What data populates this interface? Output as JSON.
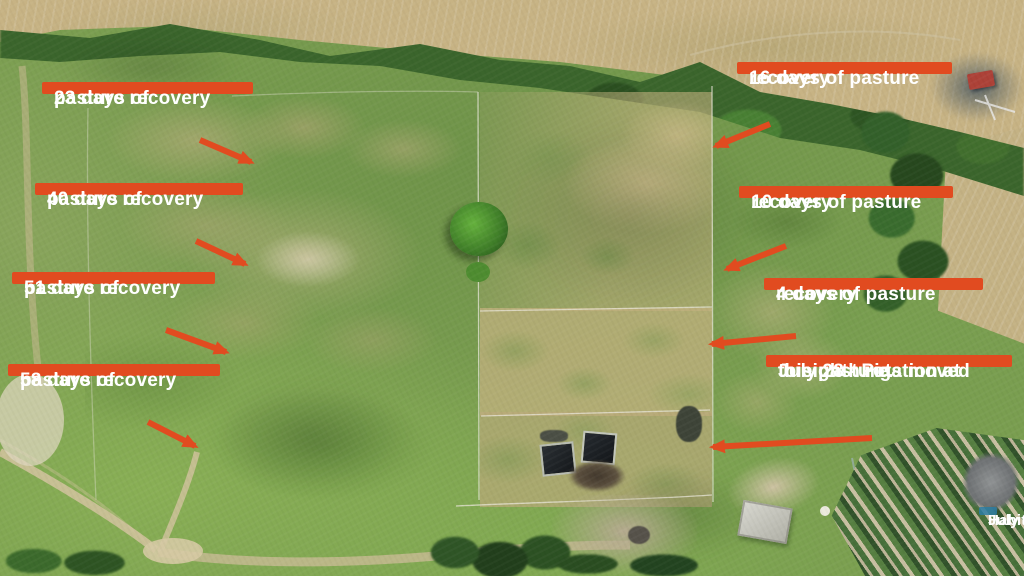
{
  "annotations": {
    "left": [
      {
        "line1": "23 days of",
        "line2": "pasture recovery"
      },
      {
        "line1": "40 days of",
        "line2": "pasture recovery"
      },
      {
        "line1": "51 days of",
        "line2": "pasture recovery"
      },
      {
        "line1": "58 days of",
        "line2": "pasture recovery"
      }
    ],
    "right": [
      {
        "line1": "16 days of pasture",
        "line2": "recovery"
      },
      {
        "line1": "10 days of pasture",
        "line2": "recovery"
      },
      {
        "line1": "4 days of pasture",
        "line2": "recovery"
      }
    ],
    "note": {
      "line1": "July 28 - Pigs moved",
      "line2": "to eighth rotation at",
      "line3": "this pasture."
    }
  },
  "stamp": {
    "line1": "July 31, 2025",
    "line2": "Habitat Buffer"
  },
  "colors": {
    "annotation_bg": "#E14B20",
    "annotation_text": "#FFFFFF",
    "stamp_bg": "#2B7CA5",
    "stamp_text": "#FFFFFF"
  }
}
